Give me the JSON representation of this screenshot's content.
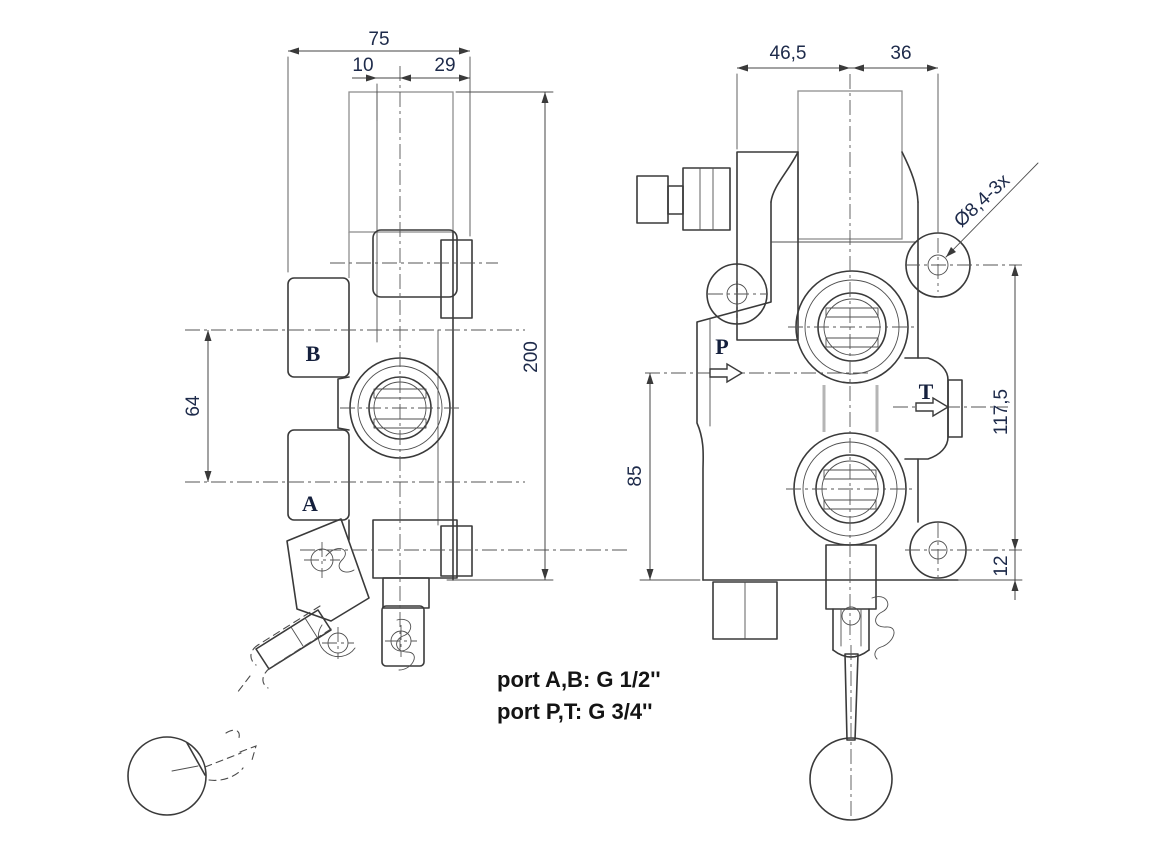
{
  "left_view": {
    "port_labels": {
      "b": "B",
      "a": "A"
    },
    "dims": {
      "overall_width": "75",
      "spool_offset": "10",
      "cap_width": "29",
      "overall_height": "200",
      "port_spacing": "64"
    }
  },
  "right_view": {
    "port_labels": {
      "p": "P",
      "t": "T"
    },
    "dims": {
      "width_left": "46,5",
      "width_right": "36",
      "mounting_hole": "Ø8,4-3x",
      "inlet_height": "85",
      "mounting_height": "117,5",
      "base_offset": "12"
    }
  },
  "notes": {
    "line1": "port A,B: G 1/2''",
    "line2": "port P,T: G 3/4''"
  },
  "colors": {
    "line": "#3a3a3a",
    "light_line": "#8f8f8f",
    "dim_line": "#464646",
    "annotation_text": "#1d2a4a",
    "background": "#ffffff"
  }
}
